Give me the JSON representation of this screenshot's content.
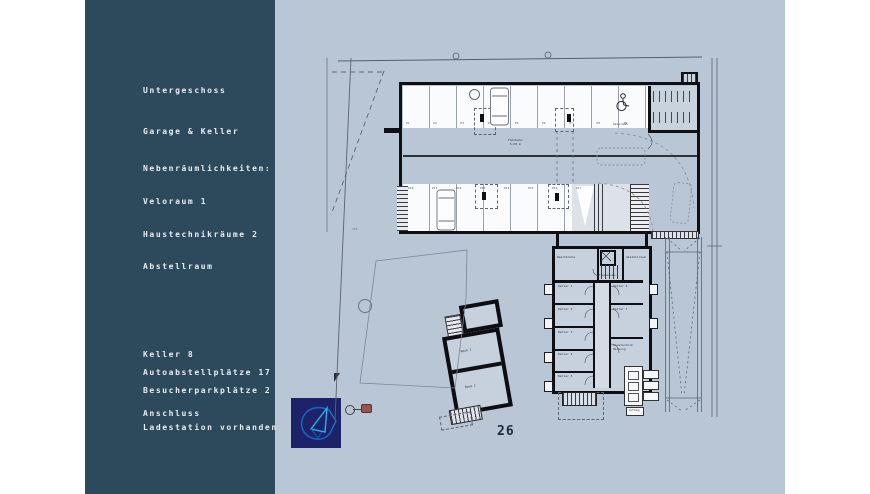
{
  "colors": {
    "background": "#b9c6d5",
    "sidebar": "#2d4a5c",
    "sidebar_text": "#e9eef2",
    "wall": "#101014",
    "logo_bg": "#1e2268",
    "logo_blue_1": "#1565c0",
    "logo_blue_2": "#2bb3ea",
    "accent_red": "#96544c"
  },
  "sidebar": {
    "lines": [
      "Untergeschoss",
      "Garage & Keller",
      "Nebenräumlichkeiten:",
      "Veloraum 1",
      "Haustechnikräume 2",
      "Abstellraum",
      "Keller 8",
      "Autoabstellplätze 17",
      "Besucherparkplätze 2",
      "Anschluss",
      "Ladestation vorhanden"
    ]
  },
  "plan": {
    "aisle_label_1": "Fahrbahn",
    "aisle_label_2": "6.00 m",
    "misc_number": "758",
    "stalls_top": [
      "P1",
      "P2",
      "P3",
      "P4",
      "P5",
      "P6",
      "P7",
      "P8",
      "P9"
    ],
    "stalls_bottom": [
      "P10",
      "P11",
      "P12",
      "P13",
      "P14",
      "P15",
      "P16",
      "P17"
    ],
    "cellar_left": [
      "Keller 1",
      "Keller 2",
      "Keller 3",
      "Keller 4",
      "Keller 5"
    ],
    "cellar_right": [
      "Keller 6",
      "Keller 7"
    ],
    "room_laundry": "Waschküche",
    "room_stair": "Treppenhaus",
    "room_storage": "Abstellraum",
    "room_tech": "Haustechnik",
    "room_heat": "Heizung",
    "room_velo": "Veloraum",
    "old_room_1": "Raum 1",
    "old_room_2": "Raum 2",
    "equipment_label": "Lüftung"
  },
  "footer": {
    "page_number": "26"
  }
}
